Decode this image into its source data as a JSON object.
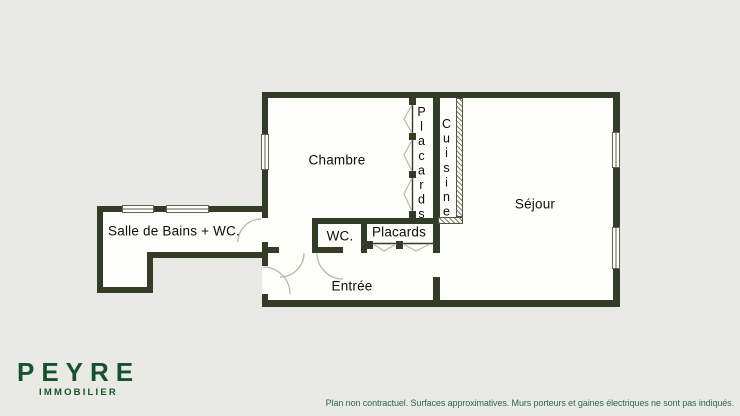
{
  "plan": {
    "rooms": {
      "chambre": "Chambre",
      "sejour": "Séjour",
      "cuisine": "Cuisine",
      "placards_chambre": "Placards",
      "wc": "WC.",
      "placards_entree": "Placards",
      "entree": "Entrée",
      "salle_de_bains": "Salle de Bains + WC."
    }
  },
  "logo": {
    "title": "PEYRE",
    "subtitle": "IMMOBILIER"
  },
  "footer": {
    "disclaimer": "Plan non contractuel. Surfaces approximatives. Murs porteurs et gaines électriques ne sont pas indiqués."
  },
  "colors": {
    "wall": "#323c26",
    "logo-green": "#17512f",
    "disclaimer-green": "#2e6847",
    "background": "#e9e9e6",
    "floor": "#fdfdfa"
  }
}
